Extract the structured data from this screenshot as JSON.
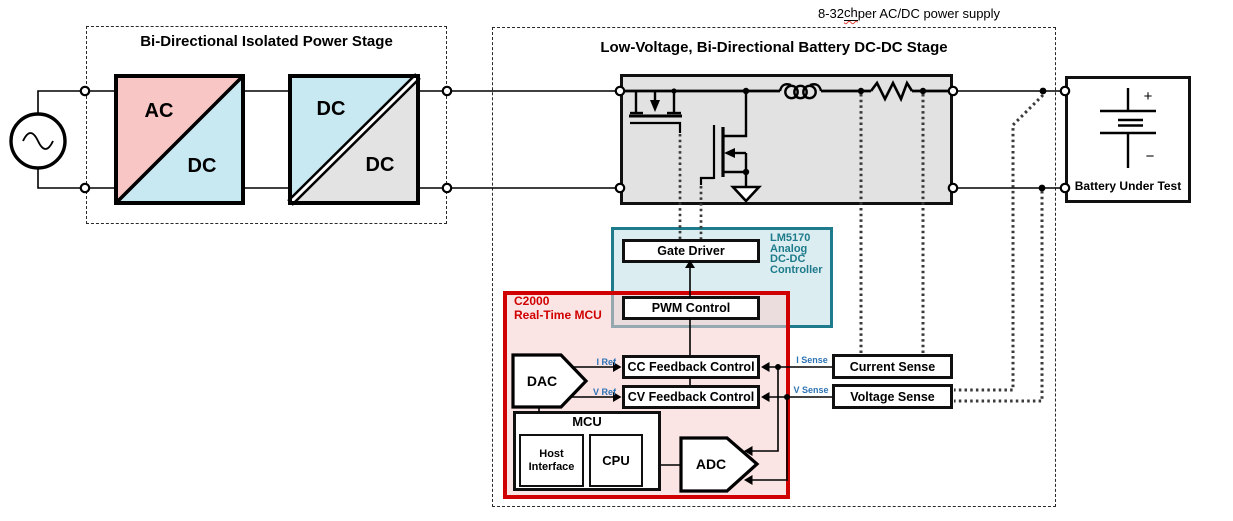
{
  "top_note": {
    "pre": "8-32 ",
    "misspelled": "ch",
    "post": " per AC/DC power supply"
  },
  "left_stage": {
    "title": "Bi-Directional Isolated Power Stage",
    "acdc_block": {
      "top_label": "AC",
      "bottom_label": "DC"
    },
    "dcdc_block": {
      "top_label": "DC",
      "bottom_label": "DC"
    }
  },
  "right_stage": {
    "title": "Low-Voltage, Bi-Directional Battery DC-DC Stage"
  },
  "lm5170": {
    "lines": [
      "LM5170",
      "Analog",
      "DC-DC",
      "Controller"
    ]
  },
  "c2000": {
    "lines": [
      "C2000",
      "Real-Time MCU"
    ]
  },
  "blocks": {
    "gate_driver": "Gate Driver",
    "pwm_control": "PWM Control",
    "cc_feedback": "CC Feedback Control",
    "cv_feedback": "CV Feedback Control",
    "current_sense": "Current Sense",
    "voltage_sense": "Voltage Sense",
    "dac": "DAC",
    "adc": "ADC",
    "mcu": "MCU",
    "host_interface": "Host Interface",
    "cpu": "CPU"
  },
  "signals": {
    "i_ref": "I Ref",
    "v_ref": "V Ref",
    "i_sense": "I Sense",
    "v_sense": "V Sense"
  },
  "battery": {
    "label": "Battery Under Test",
    "plus": "+",
    "minus": "−"
  },
  "colors": {
    "acdc_pink": "#f9c6c6",
    "converter_blue": "#c9e9f2",
    "converter_gray": "#e3e3e3",
    "power_stage_gray": "#e2e2e2",
    "teal_border": "#1e7b8b",
    "teal_fill": "#dcedf1",
    "red_border": "#d00000",
    "red_fill": "#fbe3e3",
    "signal_blue": "#2e74b5",
    "squiggle_red": "#e03c31"
  }
}
